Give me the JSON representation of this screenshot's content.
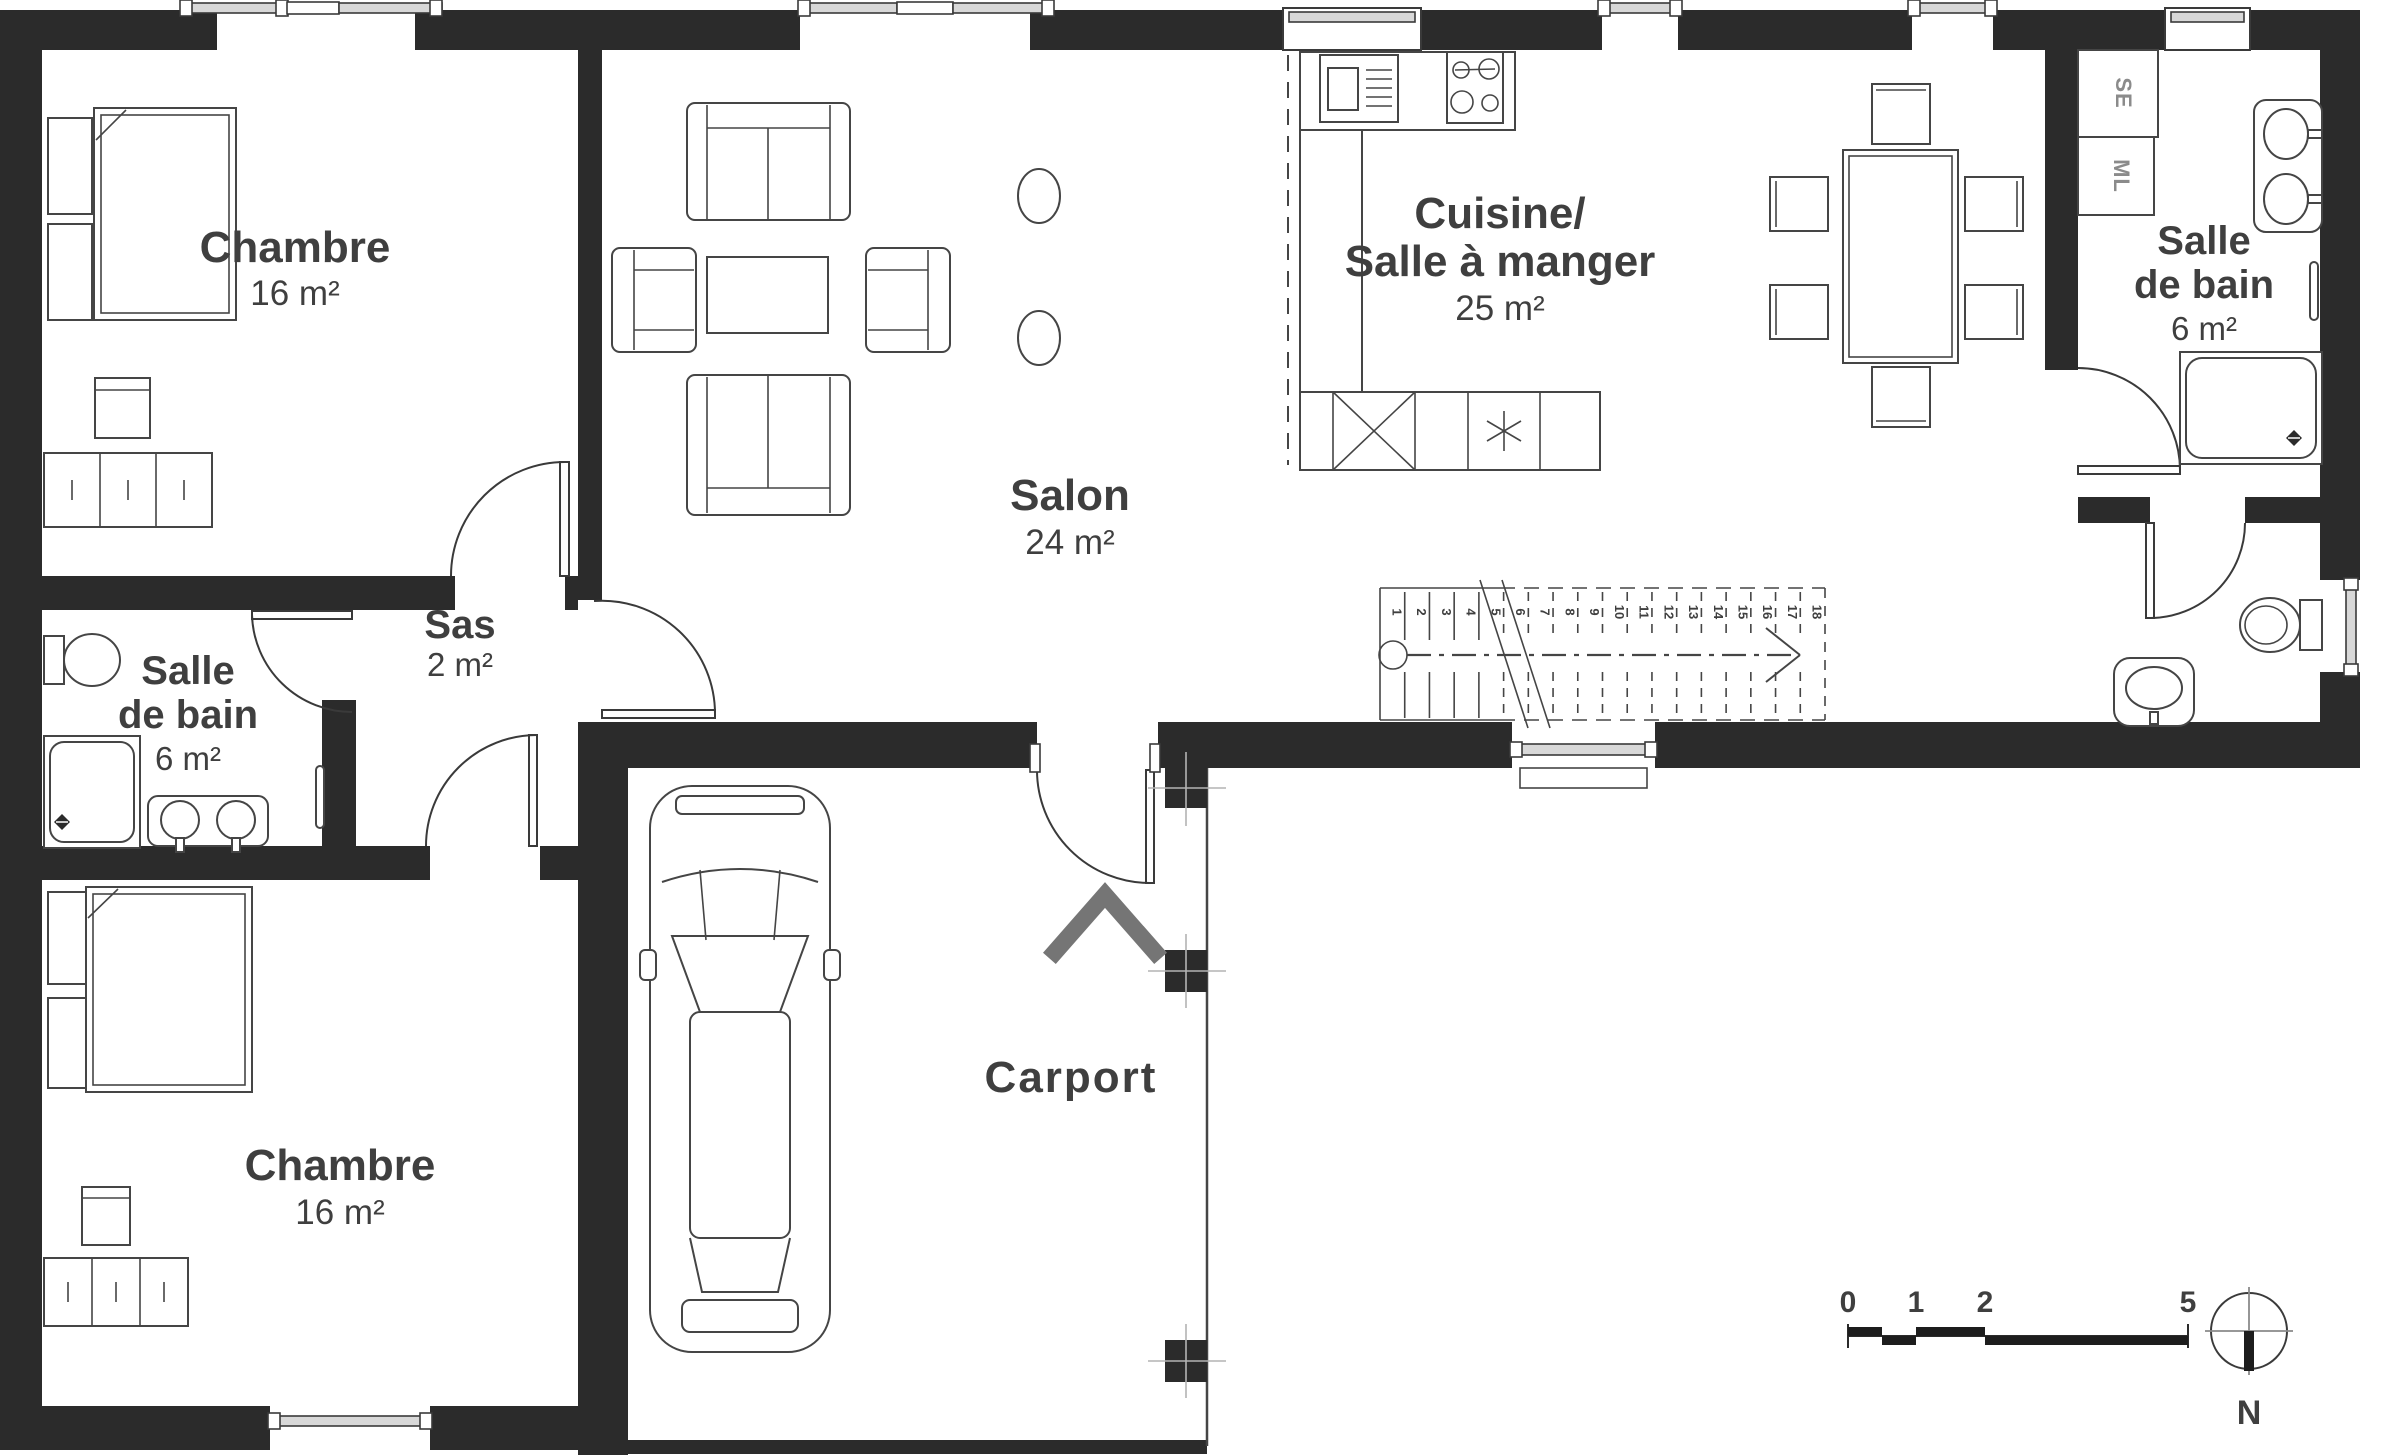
{
  "plan": {
    "title": "Plan de maison - rez-de-chaussée",
    "colors": {
      "wall": "#2b2b2b",
      "entrance_arrow": "#757575",
      "window_fill": "#d8d8d8",
      "text": "#3f3f3f"
    },
    "rooms": {
      "chambre1": {
        "label": "Chambre",
        "area": "16 m²"
      },
      "chambre2": {
        "label": "Chambre",
        "area": "16 m²"
      },
      "salon": {
        "label": "Salon",
        "area": "24 m²"
      },
      "cuisine": {
        "label_line1": "Cuisine/",
        "label_line2": "Salle à manger",
        "area": "25 m²"
      },
      "sdb_left": {
        "label_line1": "Salle",
        "label_line2": "de bain",
        "area": "6 m²"
      },
      "sdb_right": {
        "label_line1": "Salle",
        "label_line2": "de bain",
        "area": "6 m²"
      },
      "sas": {
        "label": "Sas",
        "area": "2 m²"
      },
      "carport": {
        "label": "Carport"
      }
    },
    "appliances": {
      "dryer": "SE",
      "washer": "ML"
    },
    "stairs": {
      "steps": [
        "1",
        "2",
        "3",
        "4",
        "5",
        "6",
        "7",
        "8",
        "9",
        "10",
        "11",
        "12",
        "13",
        "14",
        "15",
        "16",
        "17",
        "18"
      ]
    },
    "scale_bar": {
      "ticks": [
        "0",
        "1",
        "2",
        "5"
      ]
    },
    "compass": {
      "north": "N"
    }
  }
}
